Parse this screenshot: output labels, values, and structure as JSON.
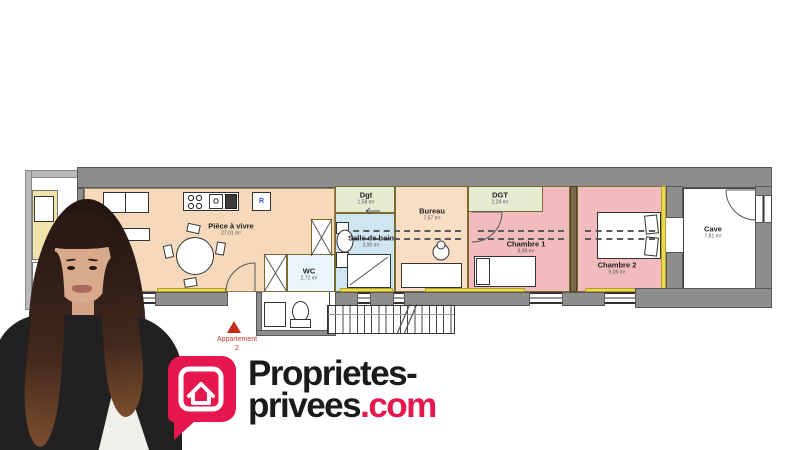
{
  "brand": {
    "logo_text_line1": "Proprietes-",
    "logo_text_line2": "privees",
    "logo_text_domain": ".com",
    "accent_color": "#E5174E"
  },
  "floorplan": {
    "marker": {
      "label": "Appartement",
      "number": "2",
      "color": "#C72C1C"
    },
    "fridge_label": "R",
    "rooms": {
      "living": {
        "name": "Pièce à vivre",
        "area": "27,01 m²"
      },
      "dgt1": {
        "name": "Dgt",
        "area": "1,58 m²"
      },
      "wc": {
        "name": "WC",
        "area": "2,72 m²"
      },
      "bathroom": {
        "name": "Salle de bain",
        "area": "3,90 m²"
      },
      "office": {
        "name": "Bureau",
        "area": "7,57 m²"
      },
      "dgt2": {
        "name": "DGT",
        "area": "2,24 m²"
      },
      "bedroom1": {
        "name": "Chambre 1",
        "area": "8,99 m²"
      },
      "bedroom2": {
        "name": "Chambre 2",
        "area": "9,06 m²"
      },
      "cellar": {
        "name": "Cave",
        "area": "7,81 m²"
      }
    },
    "colors": {
      "wall": "#8D8D8D",
      "living": "#F6D9BB",
      "office": "#F9DDC5",
      "hallway_green": "#E5ECD2",
      "bathroom_blue": "#CFE5F2",
      "bedroom_pink": "#F2BCBE",
      "highlight_yellow": "#EDD94D"
    }
  }
}
